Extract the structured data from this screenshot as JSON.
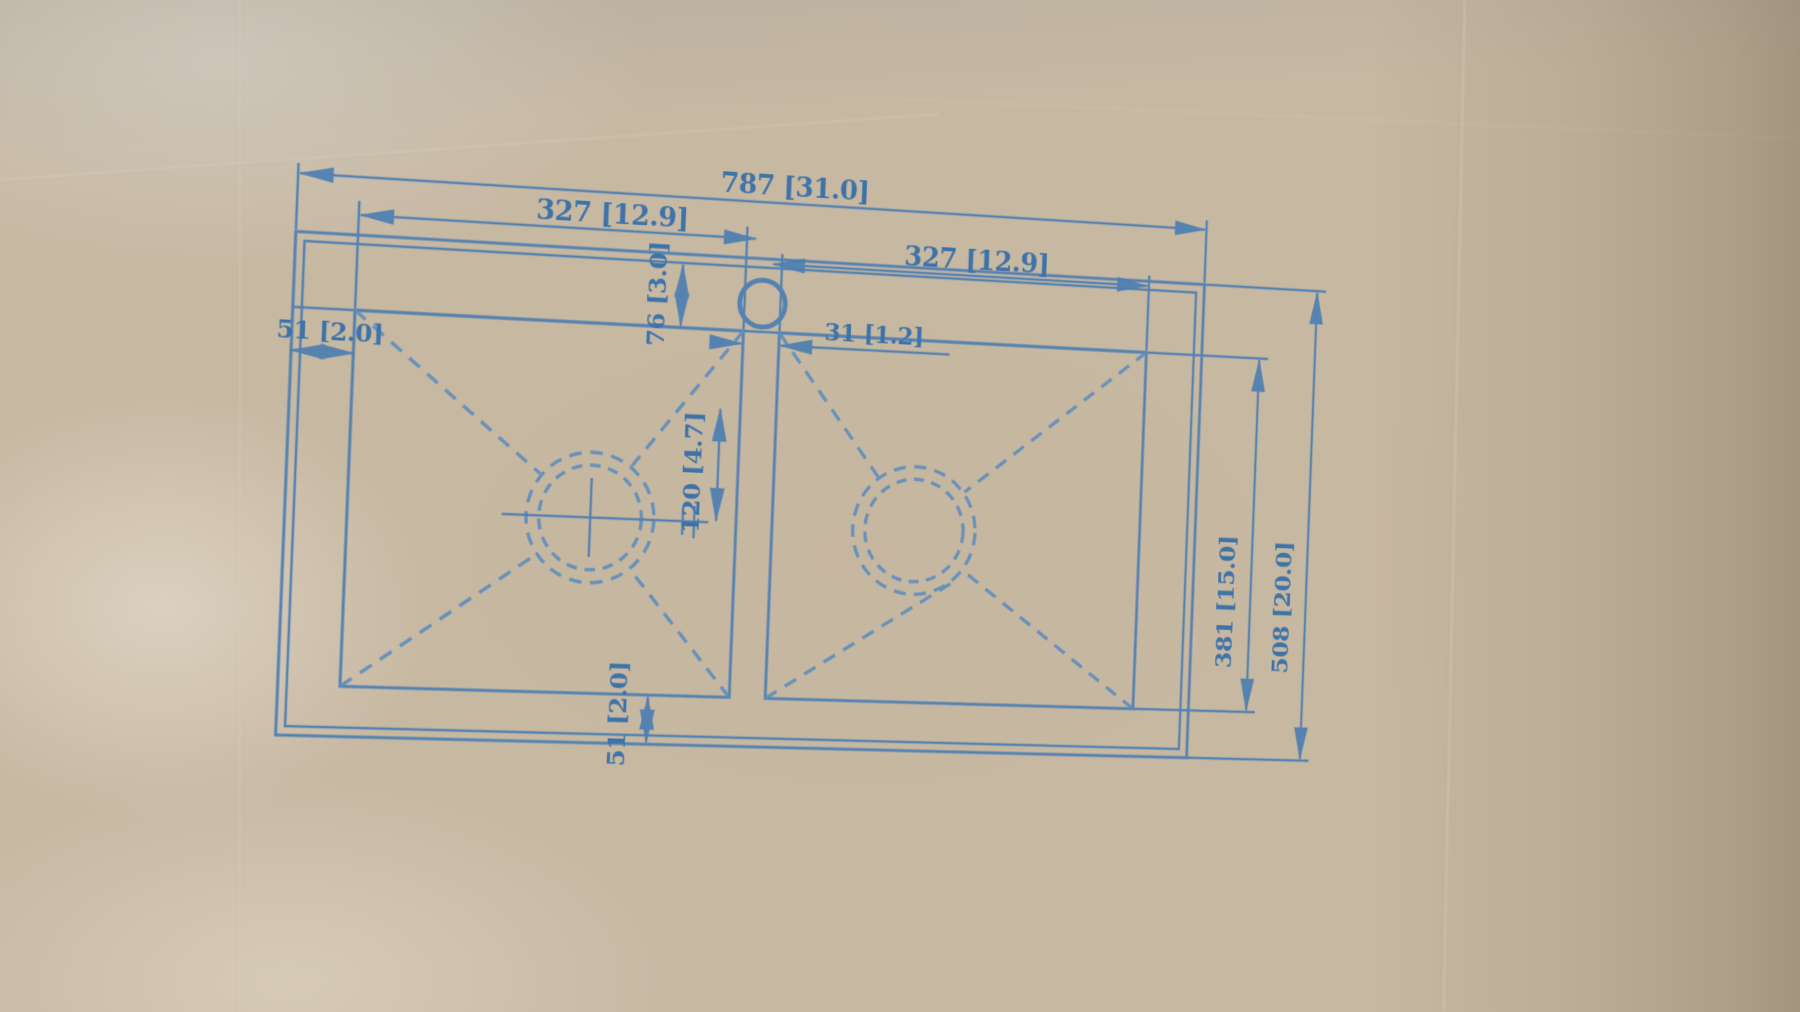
{
  "diagram": {
    "title": "double-bowl-sink-dimension-drawing",
    "ink_color": "#4a7db2",
    "cardboard_color": "#c7b8a2",
    "dims": {
      "overall_width": "787 [31.0]",
      "bowl_width_left": "327 [12.9]",
      "bowl_width_right": "327 [12.9]",
      "deck_height": "76 [3.0]",
      "rim_left": "51 [2.0]",
      "divider_width": "31 [1.2]",
      "drain_offset": "120 [4.7]",
      "rim_bottom": "51 [2.0]",
      "bowl_depth": "381 [15.0]",
      "overall_depth": "508 [20.0]"
    }
  }
}
